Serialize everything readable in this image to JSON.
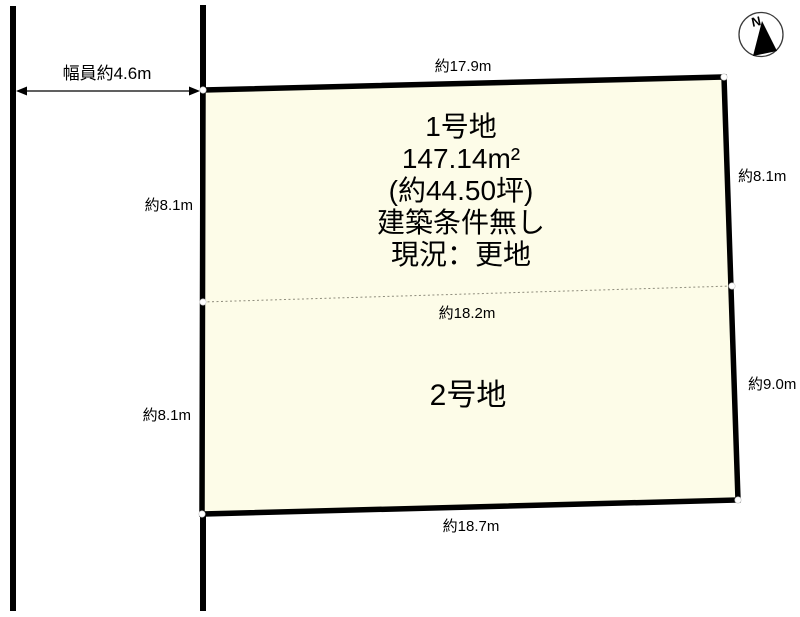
{
  "colors": {
    "plot_fill": "#FDFCE8",
    "outline": "#000000"
  },
  "road": {
    "width_label": "幅員約4.6m"
  },
  "compass": {
    "north_label": "N"
  },
  "plot1": {
    "name": "1号地",
    "area_m2": "147.14m²",
    "area_tsubo": "(約44.50坪)",
    "condition": "建築条件無し",
    "status": "現況：更地"
  },
  "plot2": {
    "name": "2号地"
  },
  "dimensions": {
    "top": "約17.9m",
    "right_upper": "約8.1m",
    "right_lower": "約9.0m",
    "left_upper": "約8.1m",
    "left_lower": "約8.1m",
    "divider": "約18.2m",
    "bottom": "約18.7m"
  }
}
